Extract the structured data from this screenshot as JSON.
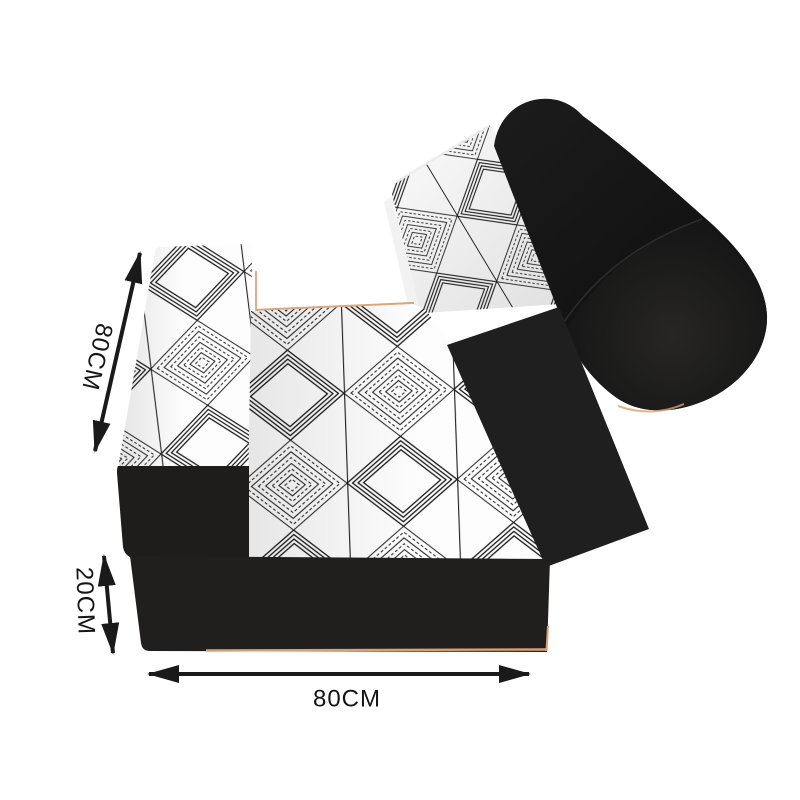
{
  "image": {
    "title": "Folding floor sofa dimension diagram",
    "background": "#ffffff"
  },
  "product": {
    "name": "folding floor sofa with bolster pillow",
    "parts": {
      "backrest": "patterned back cushion panel",
      "seat": "patterned seat cushion",
      "top_flap": "patterned folded flap cushion",
      "side_rail": "black fabric side panel",
      "bolster": "black cylindrical bolster pillow",
      "base": "black base box",
      "support_block": "black support block"
    },
    "colors": {
      "fabric_white": "#fdfdfd",
      "pattern_line": "#1b1b1b",
      "base_black": "#211f1e",
      "block_black": "#1e1d1c",
      "panel_black": "#1f1f1f",
      "cylinder_black": "#141414",
      "trim_tan": "#d9a173"
    }
  },
  "annotations": {
    "arrow_color": "#1a1a1a",
    "text_color": "#151515",
    "back_length": "80CM",
    "base_height": "20CM",
    "base_width": "80CM"
  }
}
